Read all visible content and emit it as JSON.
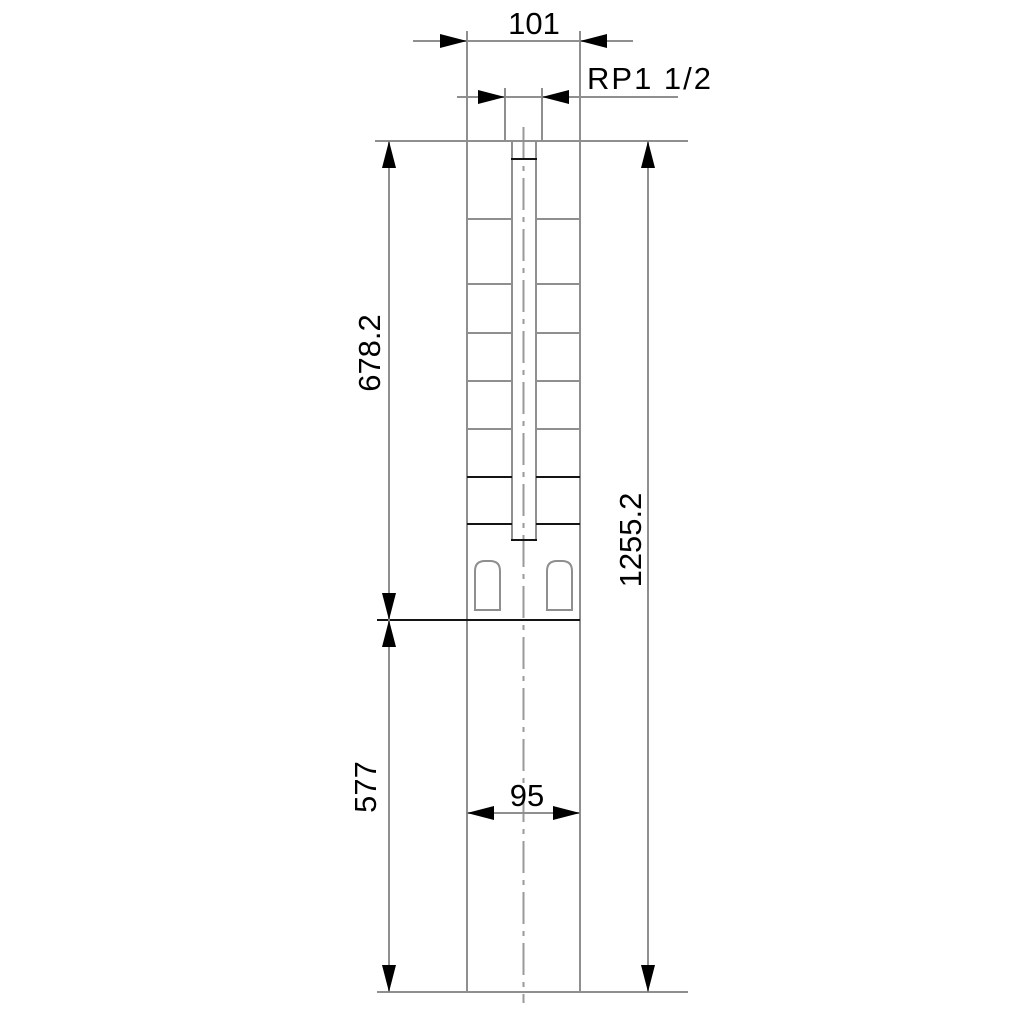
{
  "drawing": {
    "type": "technical-dimension-drawing",
    "subject": "submersible borehole pump outline, front view",
    "labels": {
      "top_width": "101",
      "thread_connection": "RP1 1/2",
      "upper_section_length": "678.2",
      "total_length": "1255.2",
      "lower_section_length": "577",
      "lower_width": "95"
    },
    "colors": {
      "background": "#ffffff",
      "outline_gray": "#8f8f8f",
      "line_black": "#141414",
      "text": "#000000"
    }
  }
}
